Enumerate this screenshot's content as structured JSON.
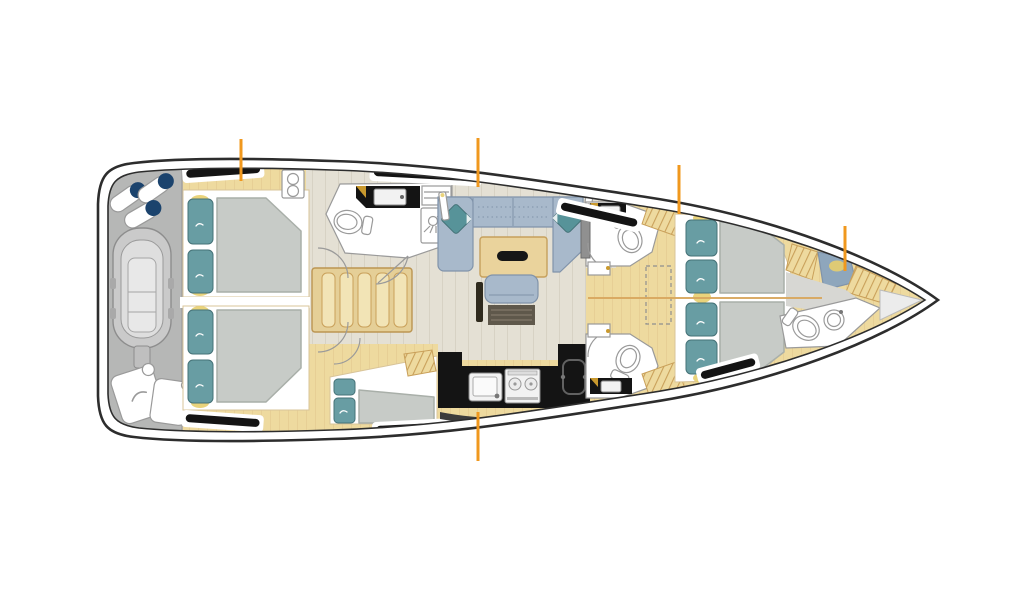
{
  "diagram": {
    "type": "sailing-yacht-interior-floor-plan",
    "orientation": {
      "bow": "right",
      "stern": "left"
    },
    "colors": {
      "hull_line": "#2d2d2d",
      "white": "#ffffff",
      "wood": "#eeda9f",
      "wood_dark": "#e2c78c",
      "wood_line": "#c9a05a",
      "wood_light": "#f2e4b6",
      "floor": "#e4e0d4",
      "floor_line": "#d3cfc1",
      "garage": "#b6b7b6",
      "dinghy": "#cacaca",
      "dinghy_inner": "#dedede",
      "fender_navy": "#1b436d",
      "mattress": "#c7cbc7",
      "mattress_line": "#a9afa9",
      "pillow": "#689da3",
      "pillow_line": "#457277",
      "yellow": "#e7ce6d",
      "sofa": "#a8b9cb",
      "sofa_line": "#8093aa",
      "cushion": "#579399",
      "counter": "#141414",
      "steel": "#f2f2f2",
      "desk": "#5f584b",
      "seat_blue": "#8ea6bc",
      "gray_floor": "#d7d7d3",
      "marker": "#f0981e",
      "gold": "#c9992e",
      "hatch": "#141414",
      "window": "#3c3c3c",
      "outline_soft": "#9a9a9a",
      "seam": "#d8a85f"
    },
    "section_markers": [
      {
        "x": 241,
        "y1": 139,
        "y2": 181
      },
      {
        "x": 478,
        "y1": 138,
        "y2": 187
      },
      {
        "x": 679,
        "y1": 165,
        "y2": 214
      },
      {
        "x": 845,
        "y1": 226,
        "y2": 271
      },
      {
        "x": 478,
        "y1": 412,
        "y2": 461
      }
    ],
    "areas": [
      "stern garage with dinghy, fenders and cans",
      "aft port double cabin",
      "aft starboard double cabin",
      "companionway stairs",
      "port head with shower",
      "saloon with U-sofa and table",
      "chart seat and desk at mast post",
      "linear galley",
      "port single-berth cabin",
      "starboard forward head (upper)",
      "starboard forward head (lower)",
      "forward owner cabin with twin berths",
      "bow head with toilet and washbasin"
    ]
  }
}
